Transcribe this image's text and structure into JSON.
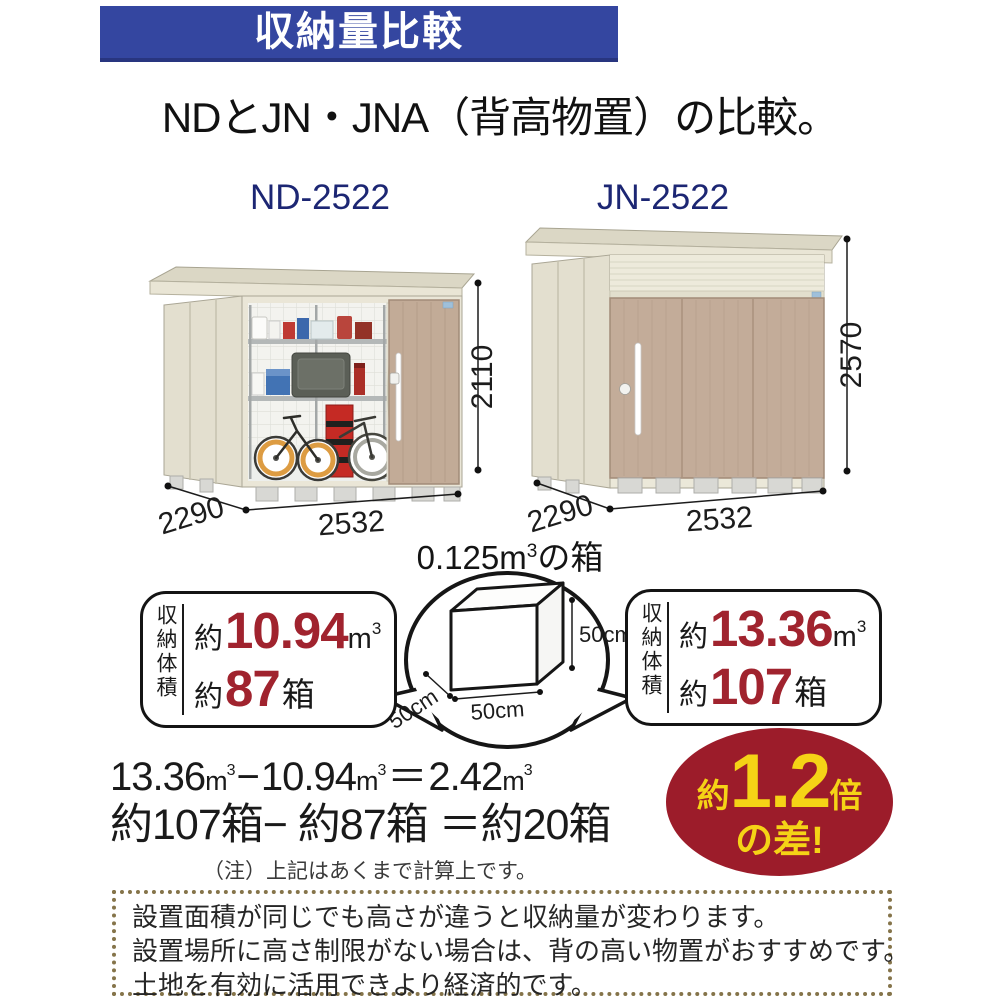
{
  "banner": {
    "title": "収納量比較",
    "bg": "#3446a0"
  },
  "heading": {
    "text": "NDとJN・JNA（背高物置）の比較。"
  },
  "sheds": {
    "left": {
      "model": "ND-2522",
      "height": "2110",
      "depth": "2290",
      "width": "2532"
    },
    "right": {
      "model": "JN-2522",
      "height": "2570",
      "depth": "2290",
      "width": "2532"
    }
  },
  "unit_box": {
    "title_value": "0.125m",
    "title_sup": "3",
    "title_suffix": "の箱",
    "side_right": "50cm",
    "side_front": "50cm",
    "side_left": "50cm"
  },
  "capacity": {
    "label": "収納体積",
    "left": {
      "approx": "約",
      "volume": "10.94",
      "unit": "m",
      "unit_sup": "3",
      "approx2": "約",
      "boxes": "87",
      "boxes_unit": "箱"
    },
    "right": {
      "approx": "約",
      "volume": "13.36",
      "unit": "m",
      "unit_sup": "3",
      "approx2": "約",
      "boxes": "107",
      "boxes_unit": "箱"
    }
  },
  "calculation": {
    "line1": {
      "v1": "13.36",
      "u1": "m",
      "s1": "3",
      "minus": "−",
      "v2": "10.94",
      "u2": "m",
      "s2": "3",
      "equals": "＝",
      "v3": "2.42",
      "u3": "m",
      "s3": "3"
    },
    "line2": "約107箱− 約87箱 ＝約20箱",
    "note": "（注）上記はあくまで計算上です。"
  },
  "badge": {
    "approx": "約",
    "value": "1.2",
    "times": "倍",
    "line2": "の差!",
    "bg": "#9c1c2a",
    "text_color": "#f5d316"
  },
  "footer": {
    "lines": [
      "設置面積が同じでも高さが違うと収納量が変わります。",
      "設置場所に高さ制限がない場合は、背の高い物置がおすすめです。",
      "土地を有効に活用できより経済的です。"
    ]
  },
  "colors": {
    "banner_bg": "#3446a0",
    "model_label": "#1c2673",
    "accent_red": "#a0232e",
    "badge_bg": "#9c1c2a",
    "badge_text": "#f5d316",
    "dotted_border": "#85744a",
    "shed_wall": "#eae6d7",
    "shed_door_tan": "#c2ab97"
  }
}
